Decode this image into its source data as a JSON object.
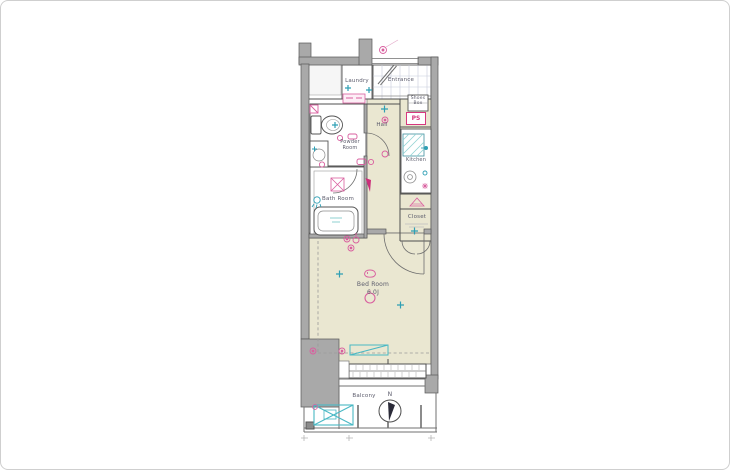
{
  "floor_plan": {
    "rooms": {
      "laundry": {
        "label": "Laundry"
      },
      "entrance": {
        "label": "Entrance"
      },
      "shoes_box": {
        "label": "Shoes Box"
      },
      "pipe_space": {
        "label": "PS"
      },
      "hall": {
        "label": "Hall"
      },
      "kitchen": {
        "label": "Kitchen"
      },
      "powder_room": {
        "label": "Powder Room"
      },
      "bath_room": {
        "label": "Bath Room"
      },
      "closet": {
        "label": "Closet"
      },
      "bed_room": {
        "label": "Bed Room",
        "size": "6.0J"
      },
      "balcony": {
        "label": "Balcony"
      }
    },
    "compass": {
      "north_label": "N"
    },
    "symbols": {
      "pink": [
        "doorbell-icon",
        "outlet-icon",
        "switch-icon",
        "ceiling-light-icon",
        "drain-hatch-icon",
        "washing-machine-pan-icon",
        "breaker-triangle-icon"
      ],
      "teal": [
        "fire-alarm-icon",
        "faucet-icon",
        "shower-icon",
        "sink-hatch-icon",
        "outdoor-unit-icon",
        "window-counter-icon"
      ]
    },
    "colors": {
      "floor_cream": "#eae7d1",
      "wall_gray": "#a9a9a9",
      "symbol_pink": "#d95f9f",
      "symbol_teal": "#2f9fb4",
      "equipment_teal": "#49b8c4",
      "text_gray": "#5b5b6b"
    }
  }
}
